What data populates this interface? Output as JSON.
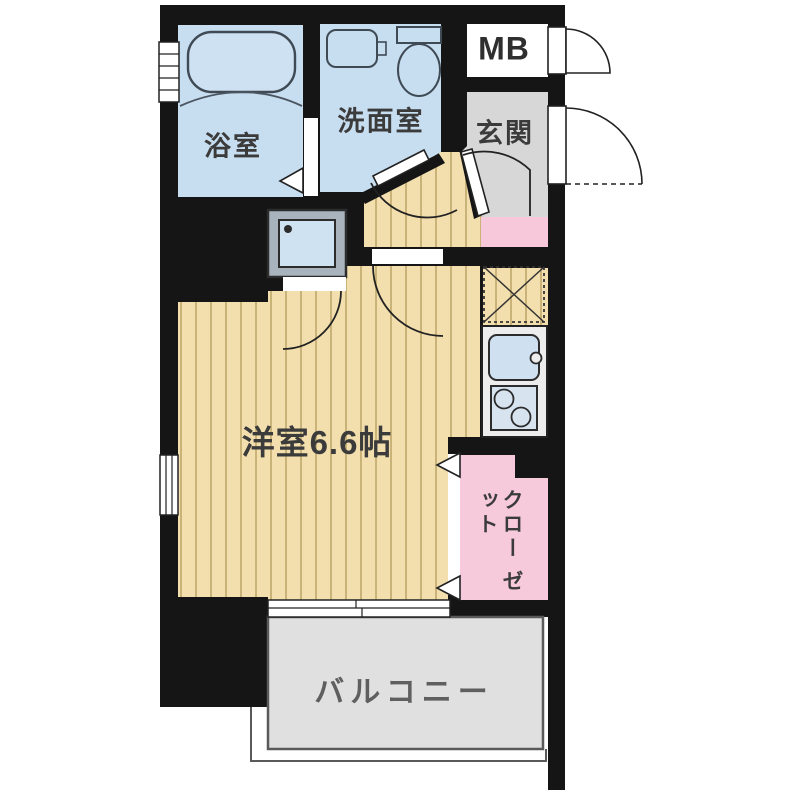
{
  "plan_title": "1K apartment floor plan",
  "rooms": {
    "bathroom": {
      "label": "浴室"
    },
    "washroom": {
      "label": "洗面室"
    },
    "meter_box": {
      "label": "MB"
    },
    "entrance": {
      "label": "玄関"
    },
    "western_room": {
      "label": "洋室6.6帖",
      "area_tatami": "6.6帖"
    },
    "closet": {
      "label_column_right": "クロー",
      "label_column_left": "ゼット"
    },
    "balcony": {
      "label": "バルコニー"
    }
  },
  "fixtures": [
    "bathtub",
    "vanity-sink",
    "toilet",
    "washing-machine",
    "refrigerator-space",
    "kitchen-sink",
    "stove",
    "door-swings",
    "sliding-window",
    "folding-doors"
  ],
  "colors": {
    "wall": "#151515",
    "wood_floor": "#f3dfae",
    "wood_stripe": "#c9b378",
    "wet_room_blue": "#c7ddf0",
    "entrance_gray": "#d7d7d7",
    "hallway_pink": "#f7c7da",
    "closet_pink": "#f6c9db",
    "balcony_gray": "#e0e0e0",
    "counter_gray": "#ededed",
    "sink_blue": "#cfe1f1",
    "stove_blue": "#d7e3ef",
    "tub_blue": "#cde1f2",
    "washer_frame_gray": "#a9b3bd",
    "washer_screen_blue": "#cfe2f2",
    "mb_white": "#ffffff",
    "outline_dark": "#222222"
  }
}
